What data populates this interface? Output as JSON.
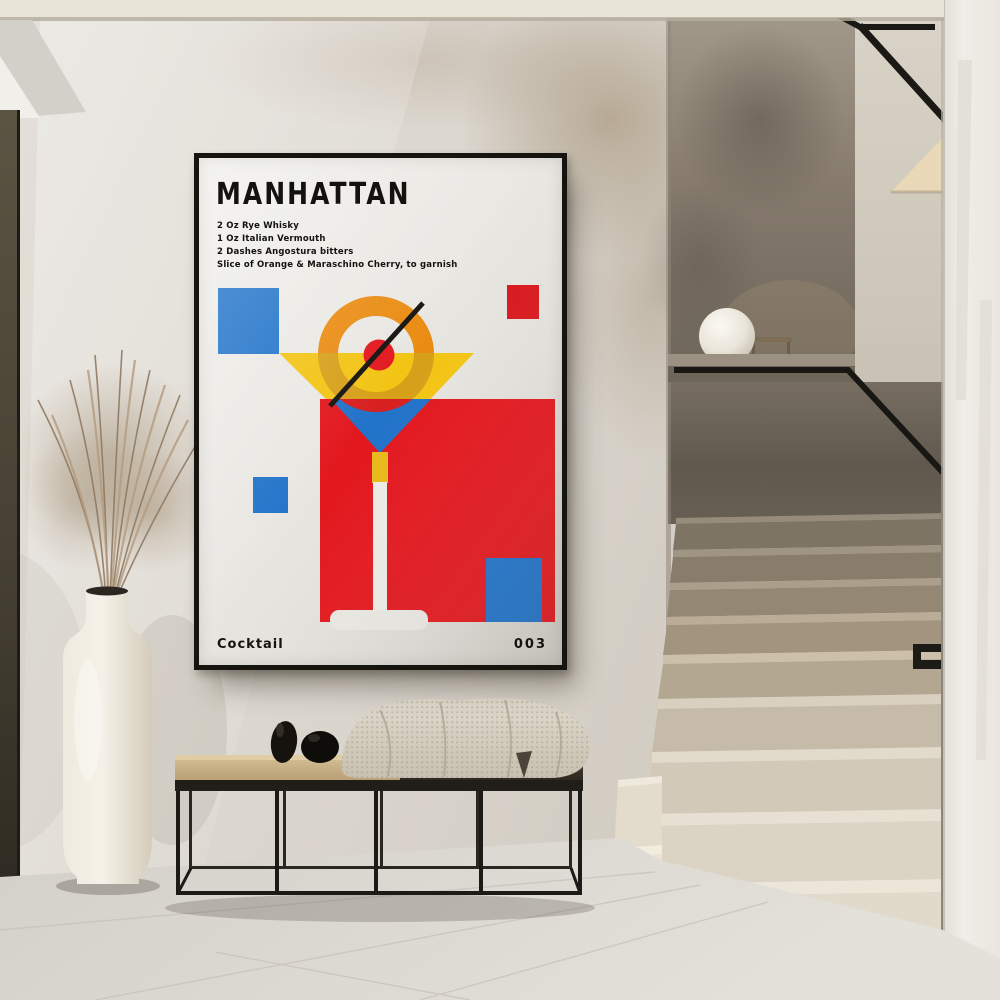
{
  "poster": {
    "title": "MANHATTAN",
    "recipe_lines": [
      "2 Oz Rye Whisky",
      "1 Oz Italian Vermouth",
      "2 Dashes Angostura bitters",
      "Slice of Orange & Maraschino Cherry, to garnish"
    ],
    "footer_left": "Cocktail",
    "footer_right": "003",
    "colors": {
      "paper": "#e9e7e2",
      "ink": "#14120e",
      "red": "#e2181e",
      "blue": "#2173c9",
      "yellow": "#f2c414",
      "orange": "#ea8c13",
      "gold": "#d7a01a"
    }
  },
  "scene": {
    "setting": "minimalist hallway with plaster walls, terrazzo staircase, black-framed bench, ceramic vase with dried pampas grass, sphere lamp on stair half-wall",
    "objects": [
      "framed poster",
      "staircase",
      "black handrail",
      "sphere lamp",
      "bench",
      "throw blanket",
      "decor stones",
      "vase",
      "pampas grass",
      "tiled floor"
    ]
  }
}
